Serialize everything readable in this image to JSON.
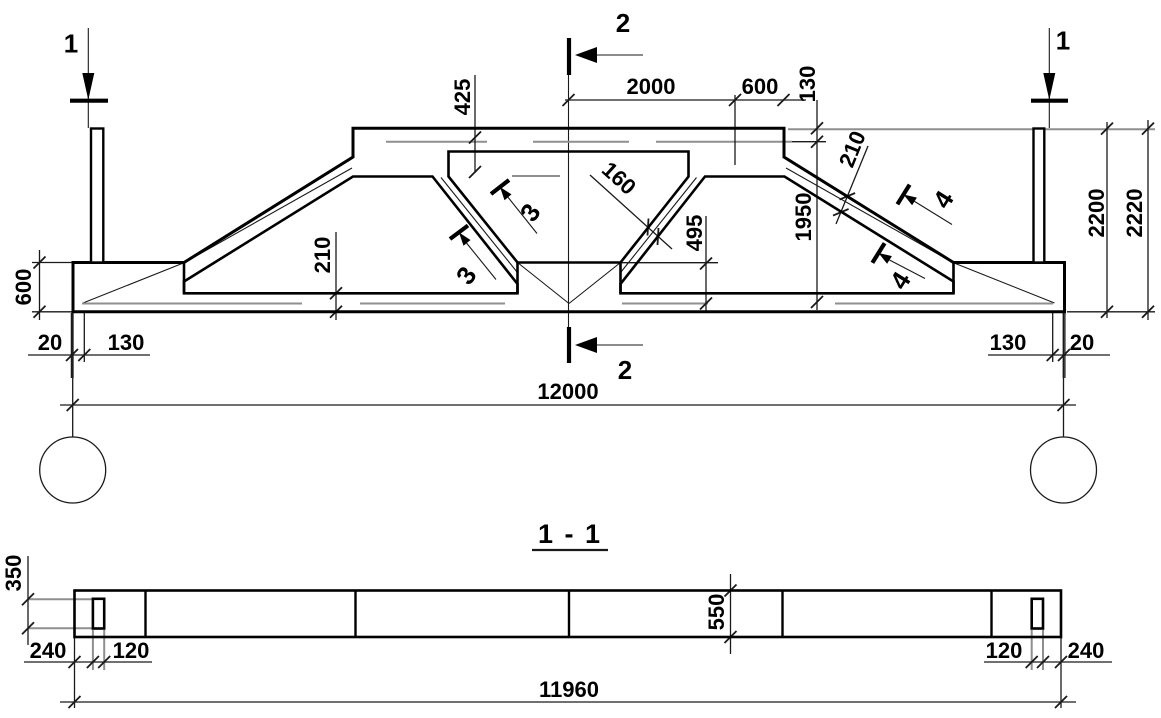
{
  "drawing": {
    "type": "structural precast truss girder elevation with longitudinal section",
    "section_view_title": "1 - 1"
  },
  "labels": {
    "sec1": "1",
    "sec2": "2",
    "sec3": "3",
    "sec4": "4",
    "dim_2000": "2000",
    "dim_600_top": "600",
    "dim_130_top": "130",
    "dim_425": "425",
    "dim_160": "160",
    "dim_1950": "1950",
    "dim_495": "495",
    "dim_210_slope": "210",
    "dim_210_chord": "210",
    "dim_600_left": "600",
    "dim_20_left": "20",
    "dim_130_left": "130",
    "dim_130_right": "130",
    "dim_20_right": "20",
    "dim_12000": "12000",
    "dim_2200": "2200",
    "dim_2220": "2220",
    "section_title": "1 - 1",
    "dim_350": "350",
    "dim_550": "550",
    "dim_240_left": "240",
    "dim_120_left": "120",
    "dim_120_right": "120",
    "dim_240_right": "240",
    "dim_11960": "11960"
  }
}
